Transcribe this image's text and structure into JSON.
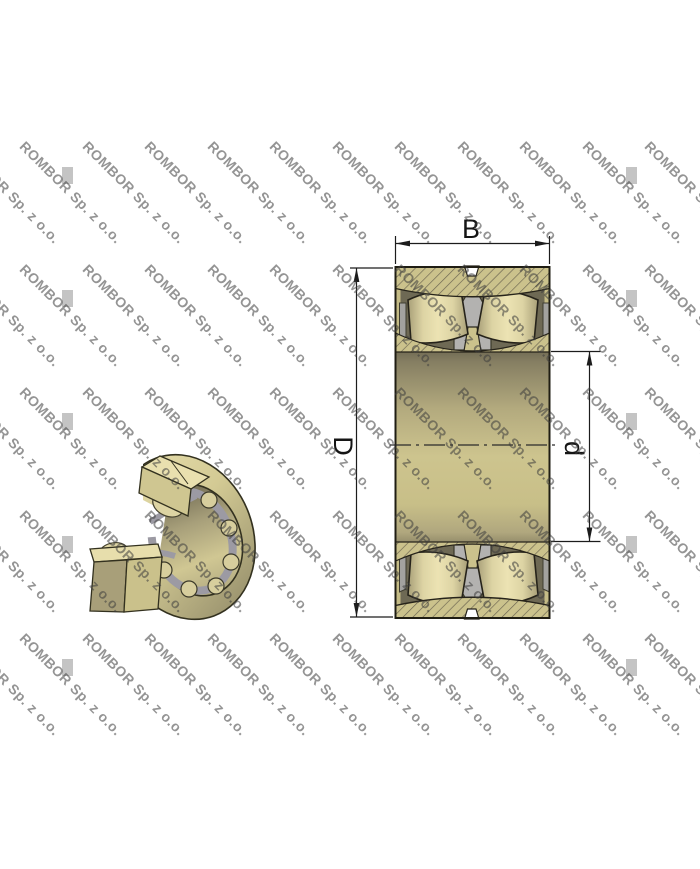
{
  "watermark": {
    "text": "ROMBOR Sp. z o.o.",
    "color": "#3d3d3d",
    "opacity": 0.55,
    "angle_deg": 45,
    "font_size_px": 14,
    "grid": {
      "x_start": -34.5,
      "x_step": 62.5,
      "cols": 12,
      "y_start": 138,
      "y_step": 123,
      "rows": 5
    },
    "artifacts": {
      "xs": [
        62,
        626
      ],
      "y_start": 167,
      "y_step": 123,
      "rows": 5,
      "color": "#c4c4c4",
      "w": 11,
      "h": 17
    }
  },
  "figure": {
    "subject": "spherical roller bearing technical drawing",
    "views": {
      "left": "3d-cutaway-view",
      "right": "cross-section-view"
    },
    "dimension_labels": {
      "width": "B",
      "outer_diameter": "D",
      "bore_diameter": "d"
    }
  },
  "colors": {
    "ring": "#cbc28c",
    "hatch_line": "#6b6450",
    "cavity": "#6e6954",
    "cage": "#b3b2b0",
    "rail": "#a3a29f",
    "outline": "#26231a",
    "dim_line": "#1c1c1c",
    "background": "#ffffff"
  }
}
